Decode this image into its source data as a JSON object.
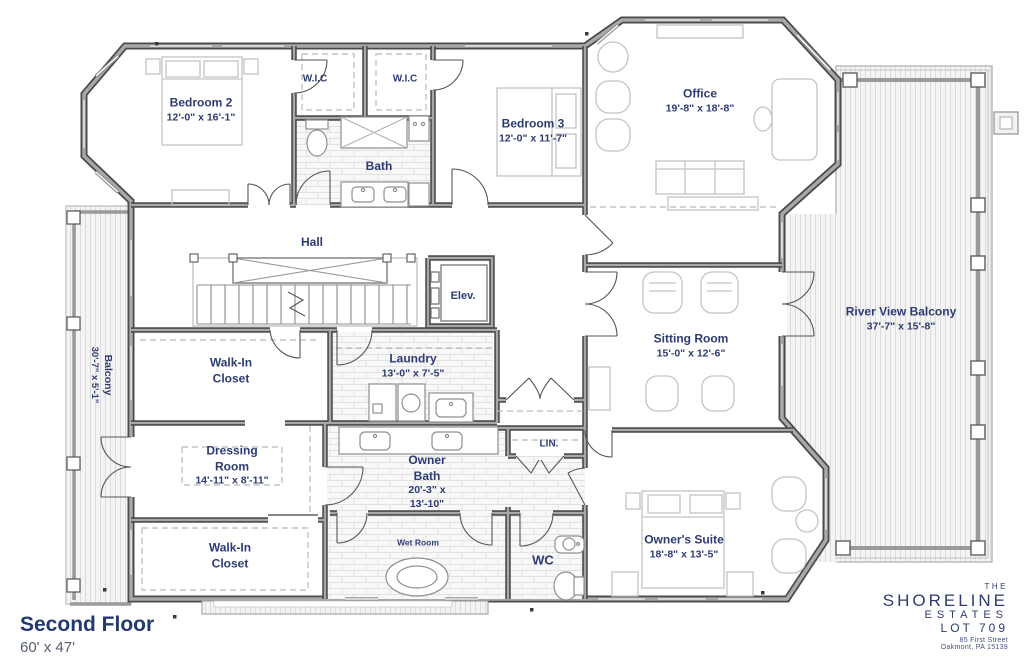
{
  "floor_plan": {
    "rooms": {
      "bedroom2": {
        "name": "Bedroom 2",
        "dims": "12'-0\" x 16'-1\""
      },
      "wic_left": {
        "name": "W.I.C"
      },
      "wic_right": {
        "name": "W.I.C"
      },
      "bath": {
        "name": "Bath"
      },
      "bedroom3": {
        "name": "Bedroom 3",
        "dims": "12'-0\" x 11'-7\""
      },
      "office": {
        "name": "Office",
        "dims": "19'-8\" x 18'-8\""
      },
      "hall": {
        "name": "Hall"
      },
      "elevator": {
        "name": "Elev."
      },
      "balcony_left": {
        "name": "Balcony",
        "dims": "30'-7\" x 5'-1\""
      },
      "river_view_balcony": {
        "name": "River View Balcony",
        "dims": "37'-7\" x 15'-8\""
      },
      "sitting_room": {
        "name": "Sitting Room",
        "dims": "15'-0\" x 12'-6\""
      },
      "walk_in_closet_upper": {
        "name": "Walk-In Closet"
      },
      "laundry": {
        "name": "Laundry",
        "dims": "13'-0\" x 7'-5\""
      },
      "dressing_room": {
        "name": "Dressing Room",
        "dims": "14'-11\" x 8'-11\""
      },
      "owner_bath": {
        "name": "Owner Bath",
        "dims": "20'-3\" x 13'-10\""
      },
      "linen": {
        "name": "LIN."
      },
      "walk_in_closet_lower": {
        "name": "Walk-In Closet"
      },
      "wet_room": {
        "name": "Wet Room"
      },
      "wc": {
        "name": "WC"
      },
      "owners_suite": {
        "name": "Owner's Suite",
        "dims": "18'-8\" x 13'-5\""
      }
    },
    "title_block": {
      "floor_name": "Second Floor",
      "overall_dims": "60' x 47'"
    },
    "branding": {
      "the": "THE",
      "name": "SHORELINE",
      "sub": "ESTATES",
      "lot": "LOT 709",
      "address1": "85 First Street",
      "address2": "Oakmont, PA 15139"
    },
    "colors": {
      "label_navy": "#2d3b73",
      "brand_navy": "#2e3c6e",
      "wall_gray": "#a8a8a8"
    }
  }
}
